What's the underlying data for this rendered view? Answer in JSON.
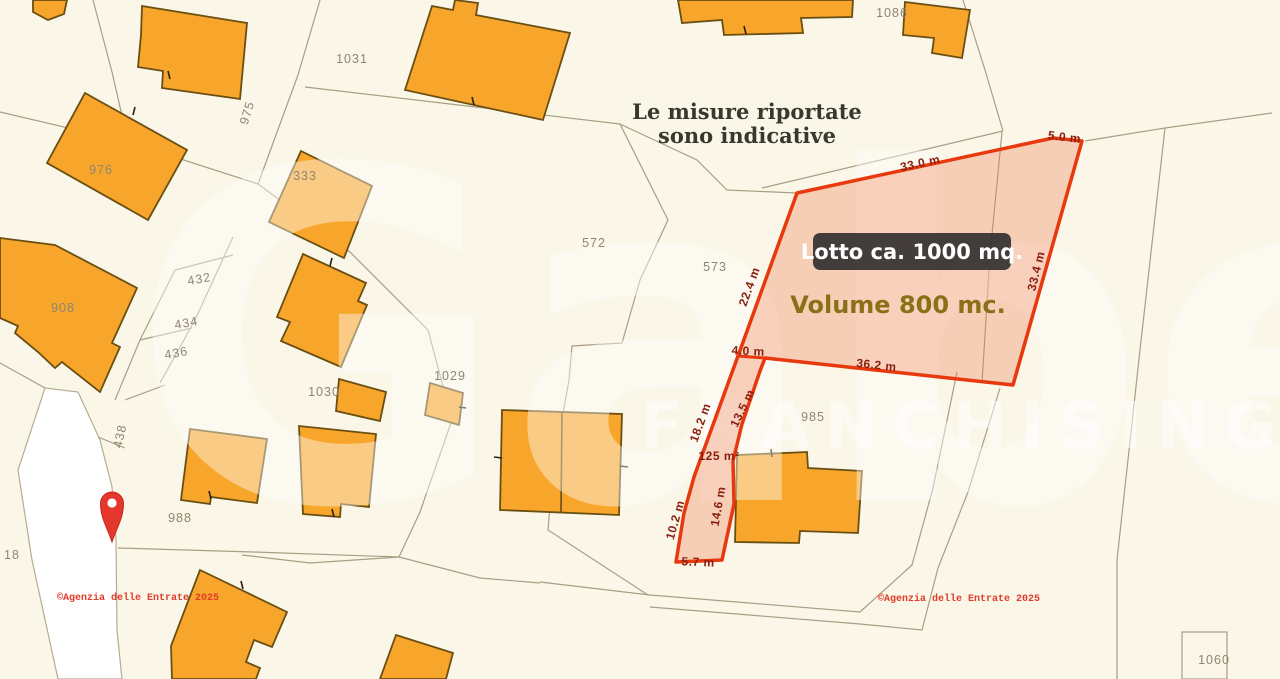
{
  "notice": {
    "line1": "Le misure riportate",
    "line2": "sono indicative"
  },
  "lot": {
    "badge": "Lotto ca. 1000 mq.",
    "volume": "Volume 800 mc."
  },
  "watermark": {
    "brand": "Gabetti",
    "sub": "FRANCHISING"
  },
  "copyright": {
    "left": "©Agenzia delle Entrate 2025",
    "right": "©Agenzia delle Entrate 2025"
  },
  "colors": {
    "background": "#faf6e8",
    "road": "#ffffff",
    "building_fill": "#f7a62b",
    "building_stroke": "#6a4e12",
    "parcel_line": "#a89e84",
    "lot_stroke": "#e8380d",
    "lot_fill": "#f0794f",
    "measurement_text": "#8a1f0e",
    "parcel_text": "#8e8672",
    "pin": "#e5372b",
    "copyright_text": "#e23b2a"
  },
  "parcel_labels": [
    {
      "text": "976",
      "x": 101,
      "y": 174,
      "rot": 0
    },
    {
      "text": "975",
      "x": 251,
      "y": 114,
      "rot": -73
    },
    {
      "text": "1031",
      "x": 352,
      "y": 63,
      "rot": 0
    },
    {
      "text": "333",
      "x": 305,
      "y": 180,
      "rot": 0
    },
    {
      "text": "432",
      "x": 200,
      "y": 283,
      "rot": -10
    },
    {
      "text": "434",
      "x": 187,
      "y": 327,
      "rot": -10
    },
    {
      "text": "436",
      "x": 177,
      "y": 357,
      "rot": -10
    },
    {
      "text": "908",
      "x": 63,
      "y": 312,
      "rot": 0
    },
    {
      "text": "1030",
      "x": 324,
      "y": 396,
      "rot": 0
    },
    {
      "text": "1029",
      "x": 450,
      "y": 380,
      "rot": 0
    },
    {
      "text": "438",
      "x": 124,
      "y": 437,
      "rot": -78
    },
    {
      "text": "988",
      "x": 180,
      "y": 522,
      "rot": 0
    },
    {
      "text": "18",
      "x": 12,
      "y": 559,
      "rot": 0
    },
    {
      "text": "572",
      "x": 594,
      "y": 247,
      "rot": 0
    },
    {
      "text": "573",
      "x": 715,
      "y": 271,
      "rot": 0
    },
    {
      "text": "985",
      "x": 813,
      "y": 421,
      "rot": 0
    },
    {
      "text": "1086",
      "x": 892,
      "y": 17,
      "rot": 0
    },
    {
      "text": "1060",
      "x": 1214,
      "y": 664,
      "rot": 0
    }
  ],
  "measurements": [
    {
      "text": "33.0 m",
      "x": 921,
      "y": 167,
      "rot": -12
    },
    {
      "text": "5.0 m",
      "x": 1064,
      "y": 141,
      "rot": 7
    },
    {
      "text": "22.4 m",
      "x": 753,
      "y": 288,
      "rot": -70
    },
    {
      "text": "33.4 m",
      "x": 1040,
      "y": 272,
      "rot": -76
    },
    {
      "text": "4.0 m",
      "x": 748,
      "y": 355,
      "rot": 3
    },
    {
      "text": "36.2 m",
      "x": 876,
      "y": 369,
      "rot": 6
    },
    {
      "text": "18.2 m",
      "x": 704,
      "y": 424,
      "rot": -70
    },
    {
      "text": "13.5 m",
      "x": 746,
      "y": 410,
      "rot": -64
    },
    {
      "text": "125 m²",
      "x": 719,
      "y": 460,
      "rot": 0
    },
    {
      "text": "14.6 m",
      "x": 722,
      "y": 507,
      "rot": -80
    },
    {
      "text": "10.2 m",
      "x": 679,
      "y": 521,
      "rot": -74
    },
    {
      "text": "5.7 m",
      "x": 698,
      "y": 566,
      "rot": 2
    }
  ]
}
